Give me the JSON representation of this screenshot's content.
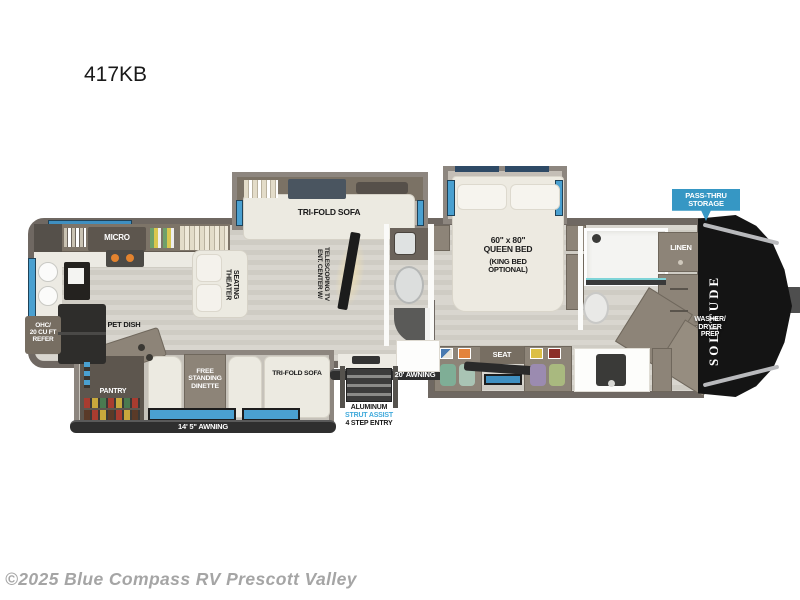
{
  "page": {
    "title": "417KB",
    "copyright": "©2025 Blue Compass RV Prescott Valley"
  },
  "exterior": {
    "pass_thru_label": "PASS-THRU\nSTORAGE",
    "brand_label": "SOLITUDE",
    "awning_left_label": "14' 5\" AWNING",
    "awning_right_label": "20' AWNING",
    "entry_line1": "ALUMINUM",
    "entry_line2": "STRUT ASSIST",
    "entry_line3": "4 STEP ENTRY"
  },
  "kitchen": {
    "micro_label": "MICRO",
    "refer_label": "OHC/\n20 CU FT\nREFER",
    "pet_dish_label": "PET DISH",
    "pantry_label": "PANTRY"
  },
  "living": {
    "sofa_top_label": "TRI-FOLD SOFA",
    "theater_label": "THEATER\nSEATING",
    "ent_center_label": "ENT. CENTER W/\nTELESCOPING TV",
    "dinette_label": "FREE\nSTANDING\nDINETTE",
    "sofa_bottom_label": "TRI-FOLD SOFA"
  },
  "bedroom": {
    "bed_size_label": "60\" x 80\"\nQUEEN BED",
    "bed_option_label": "(KING BED\nOPTIONAL)",
    "seat_label": "SEAT"
  },
  "bath": {
    "linen_label": "LINEN",
    "washer_label": "WASHER/\nDRYER\nPREP"
  },
  "colors": {
    "window_blue": "#4aa0d0",
    "flag_blue": "#3697c4",
    "strut_text_blue": "#3fa9db",
    "wall_dark": "#6f6862",
    "slide_wall": "#8d867f",
    "cabinet_taupe": "#8d8478",
    "front_cap_black": "#141414"
  }
}
